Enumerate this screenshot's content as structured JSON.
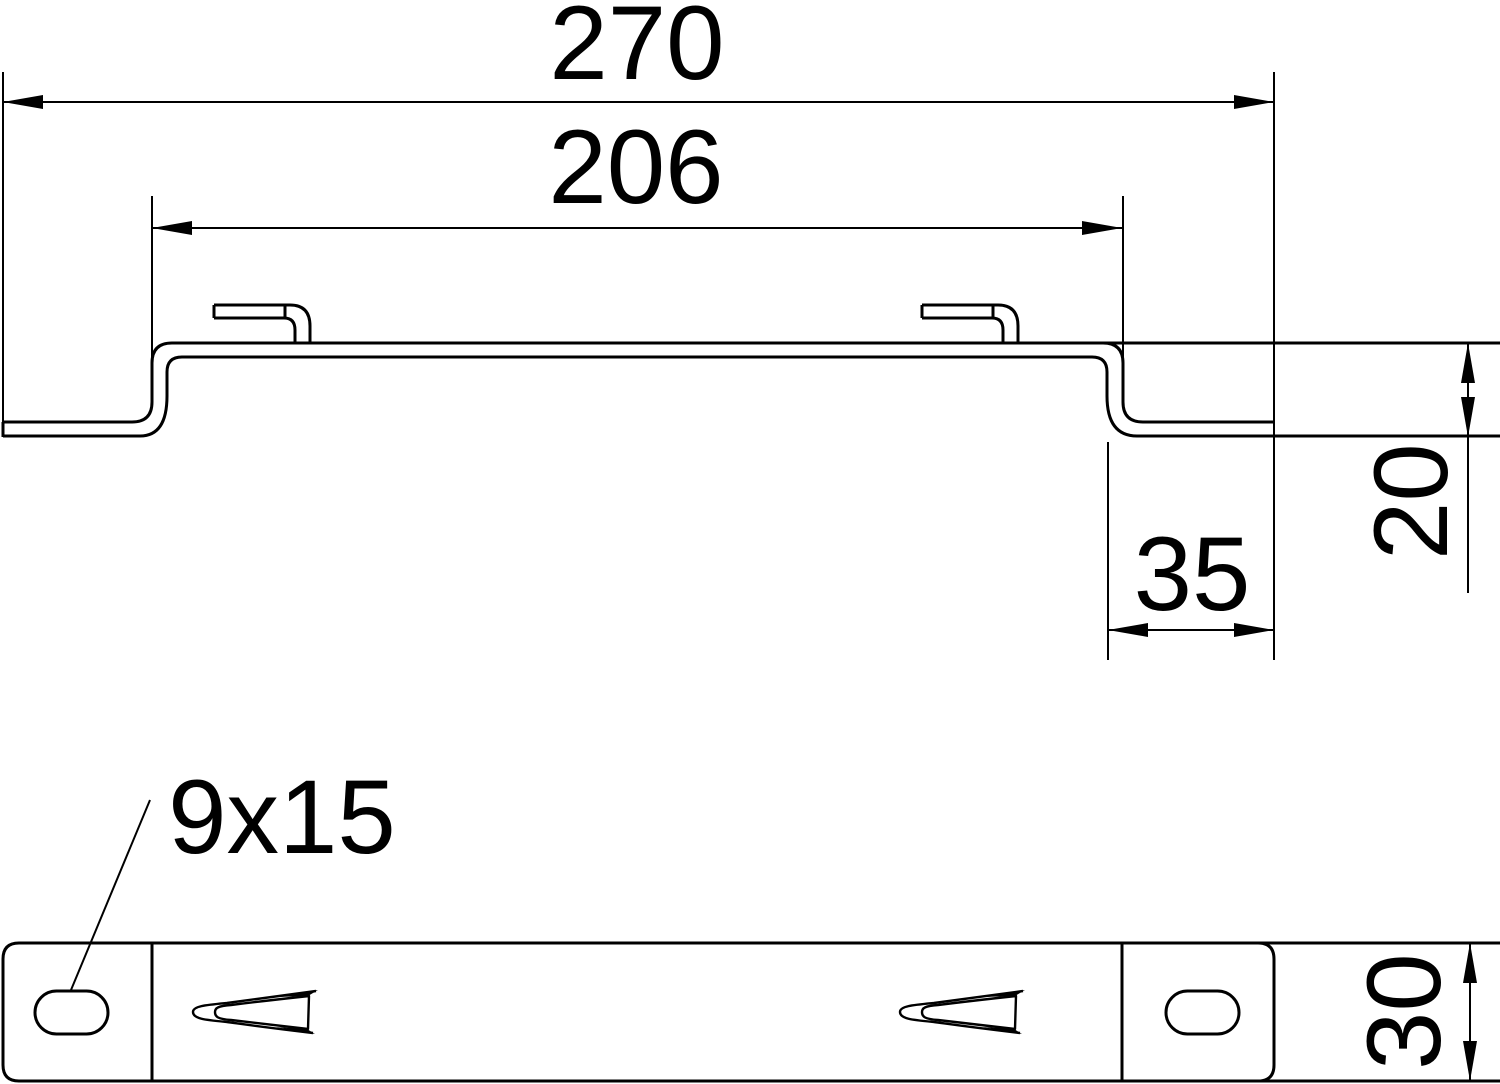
{
  "colors": {
    "background": "#ffffff",
    "line": "#000000"
  },
  "section_view": {
    "total_width_label": "270",
    "inner_width_label": "206",
    "flange_width_label": "35",
    "step_height_label": "20"
  },
  "plan_view": {
    "slot_size_label": "9x15",
    "plate_width_label": "30"
  }
}
